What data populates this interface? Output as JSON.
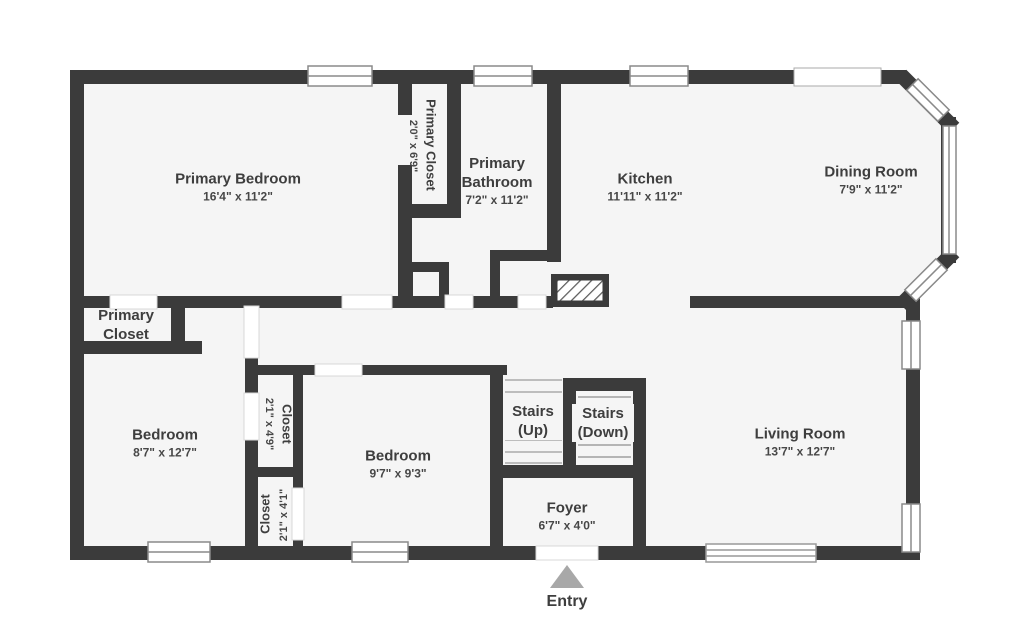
{
  "rooms": {
    "primary_bedroom": {
      "name": "Primary Bedroom",
      "dims": "16'4\" x 11'2\""
    },
    "primary_closet_top": {
      "name": "Primary Closet",
      "dims": "2'0\" x 6'9\""
    },
    "primary_bathroom": {
      "name": "Primary Bathroom",
      "dims": "7'2\" x 11'2\""
    },
    "kitchen": {
      "name": "Kitchen",
      "dims": "11'11\" x 11'2\""
    },
    "dining_room": {
      "name": "Dining Room",
      "dims": "7'9\" x 11'2\""
    },
    "primary_closet_left": {
      "name": "Primary Closet"
    },
    "bedroom_left": {
      "name": "Bedroom",
      "dims": "8'7\" x 12'7\""
    },
    "closet_upper": {
      "name": "Closet",
      "dims": "2'1\" x 4'9\""
    },
    "closet_lower": {
      "name": "Closet",
      "dims": "2'1\" x 4'1\""
    },
    "bedroom_middle": {
      "name": "Bedroom",
      "dims": "9'7\" x 9'3\""
    },
    "stairs_up": {
      "name": "Stairs (Up)"
    },
    "stairs_down": {
      "name": "Stairs (Down)"
    },
    "foyer": {
      "name": "Foyer",
      "dims": "6'7\" x 4'0\""
    },
    "living_room": {
      "name": "Living Room",
      "dims": "13'7\" x 12'7\""
    }
  },
  "entry": {
    "label": "Entry"
  },
  "colors": {
    "wall": "#3b3b3b",
    "floor": "#f5f5f5",
    "background": "#ffffff",
    "window_frame": "#8a8a8a",
    "stair_tread": "#bdbdbd",
    "entry_arrow": "#a8a8a8",
    "text": "#3e3e3e"
  }
}
